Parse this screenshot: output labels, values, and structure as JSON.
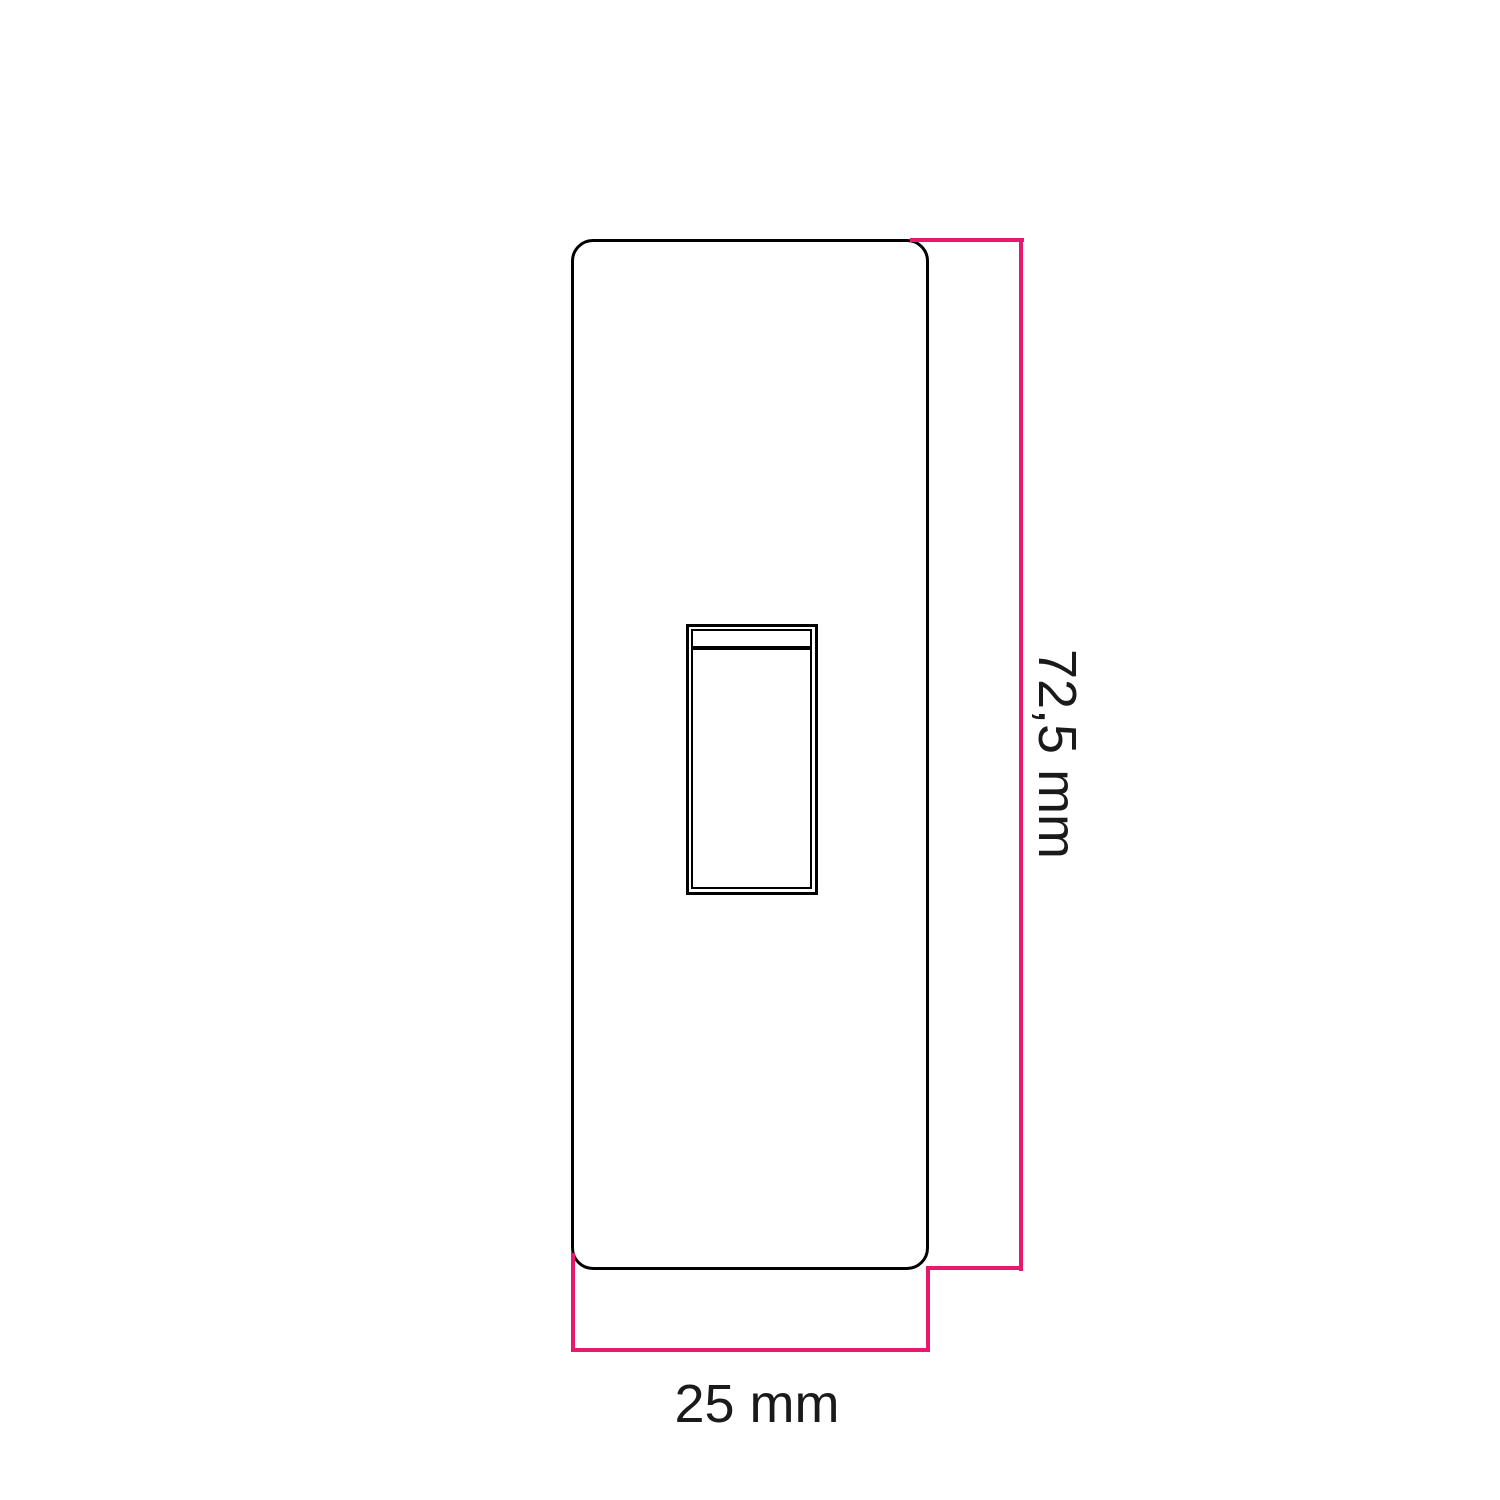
{
  "diagram": {
    "kind": "dimension-drawing",
    "labels": {
      "height_dimension": "72,5 mm",
      "width_dimension": "25 mm"
    },
    "colors": {
      "dimension": "#E8186D",
      "outline": "#000000",
      "background": "#FFFFFF",
      "text": "#1A1A1A"
    }
  }
}
